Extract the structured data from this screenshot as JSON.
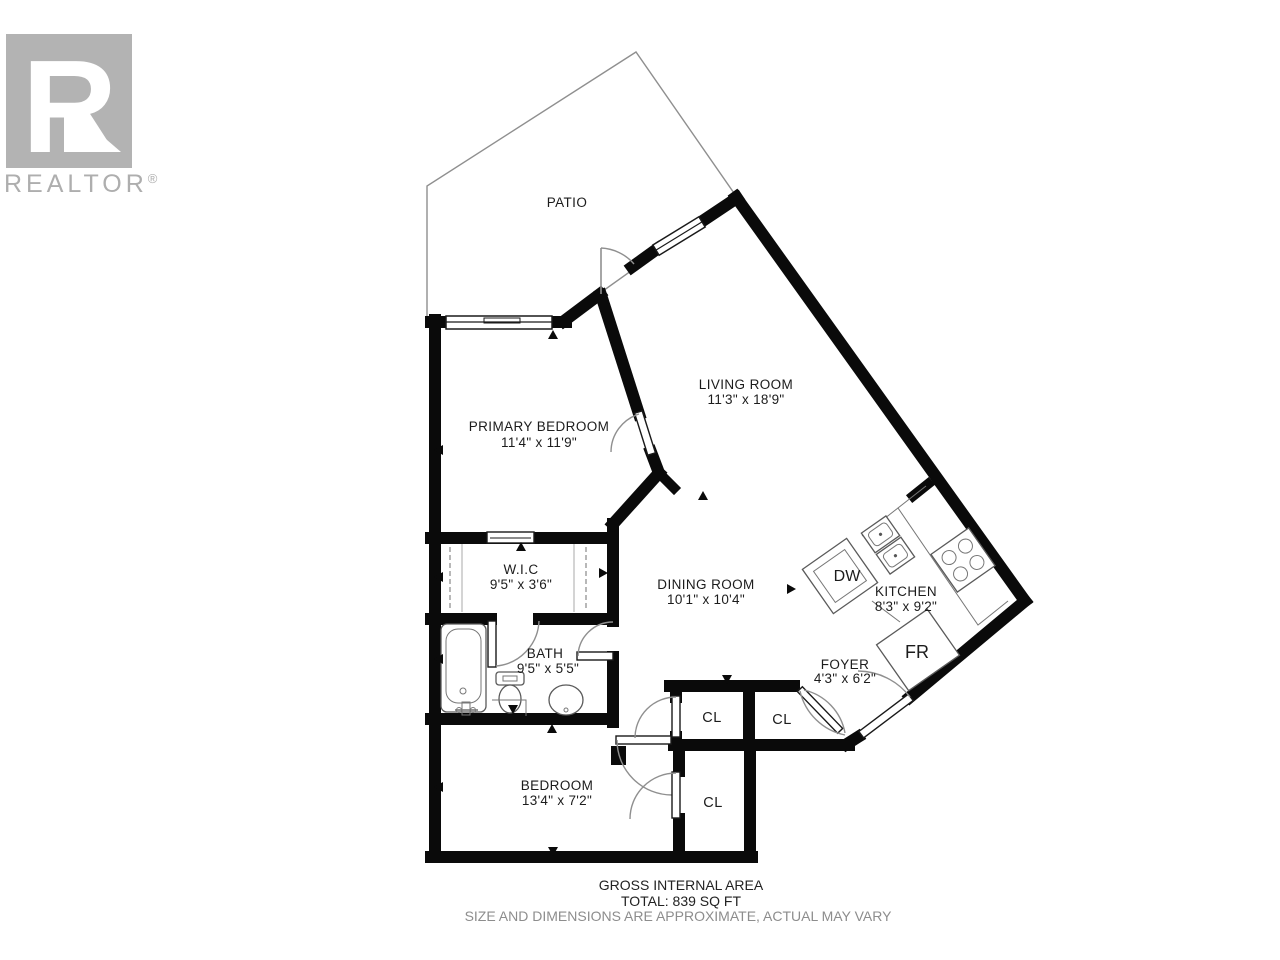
{
  "branding": {
    "logo_monogram": "R",
    "logo_text": "REALTOR",
    "reg": "®",
    "logo_color": "#b3b3b3"
  },
  "floorplan": {
    "rooms": [
      {
        "name": "PATIO",
        "dims": ""
      },
      {
        "name": "LIVING ROOM",
        "dims": "11'3\" x 18'9\""
      },
      {
        "name": "PRIMARY BEDROOM",
        "dims": "11'4\" x 11'9\""
      },
      {
        "name": "W.I.C",
        "dims": "9'5\" x 3'6\""
      },
      {
        "name": "DINING ROOM",
        "dims": "10'1\" x 10'4\""
      },
      {
        "name": "KITCHEN",
        "dims": "8'3\" x 9'2\""
      },
      {
        "name": "BATH",
        "dims": "9'5\" x 5'5\""
      },
      {
        "name": "FOYER",
        "dims": "4'3\" x 6'2\""
      },
      {
        "name": "BEDROOM",
        "dims": "13'4\" x 7'2\""
      }
    ],
    "closets": [
      "CL",
      "CL",
      "CL"
    ],
    "appliances": {
      "dishwasher": "DW",
      "fridge": "FR"
    },
    "footer": {
      "line1": "GROSS INTERNAL AREA",
      "line2": "TOTAL: 839 SQ FT",
      "line3": "SIZE AND DIMENSIONS ARE APPROXIMATE, ACTUAL MAY VARY"
    },
    "colors": {
      "wall": "#000000",
      "patio_outline": "#9a9a9a"
    }
  }
}
